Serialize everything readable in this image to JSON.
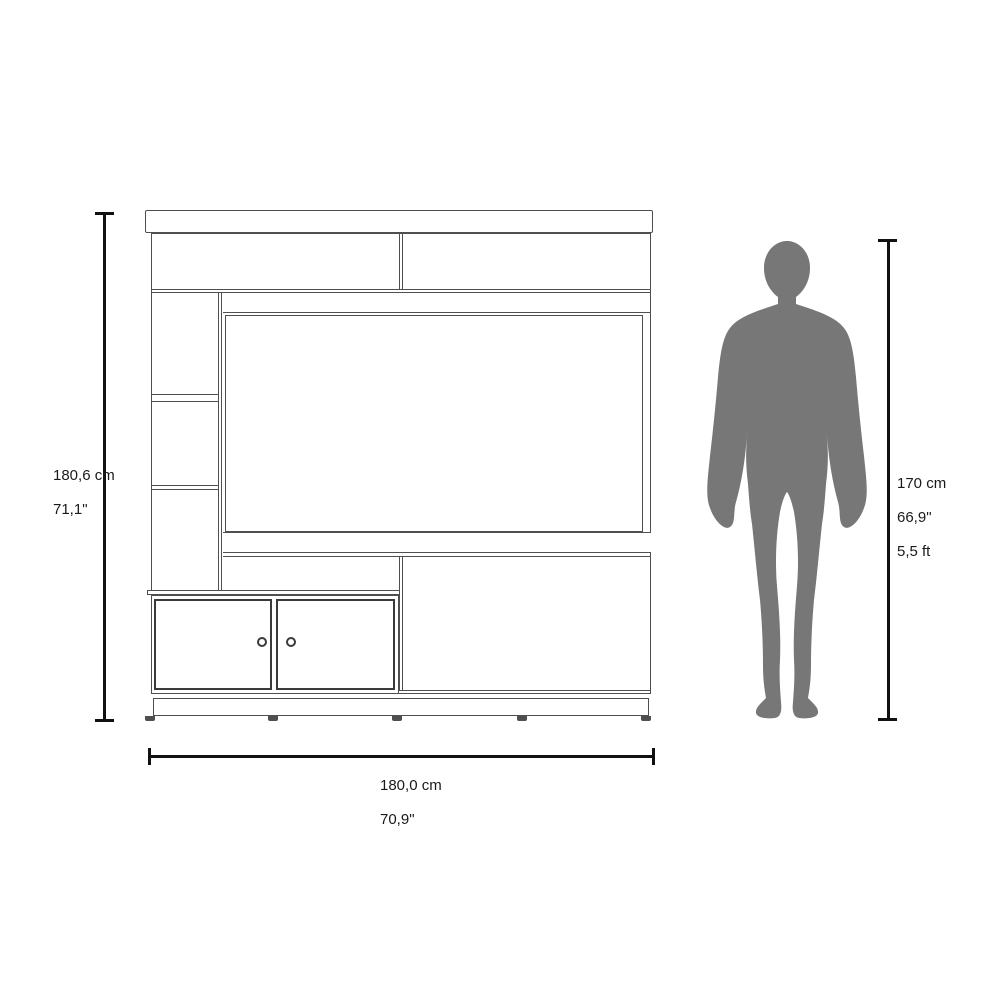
{
  "labels": {
    "furniture_height": {
      "cm": "180,6 cm",
      "inches": "71,1\""
    },
    "furniture_width": {
      "cm": "180,0 cm",
      "inches": "70,9\""
    },
    "person_height": {
      "cm": "170 cm",
      "inches": "66,9\"",
      "feet": "5,5 ft"
    }
  },
  "colors": {
    "background": "#ffffff",
    "silhouette": "#777777",
    "furniture_line": "#4f4f4f",
    "dimension_line": "#111111",
    "text": "#1a1a1a"
  }
}
